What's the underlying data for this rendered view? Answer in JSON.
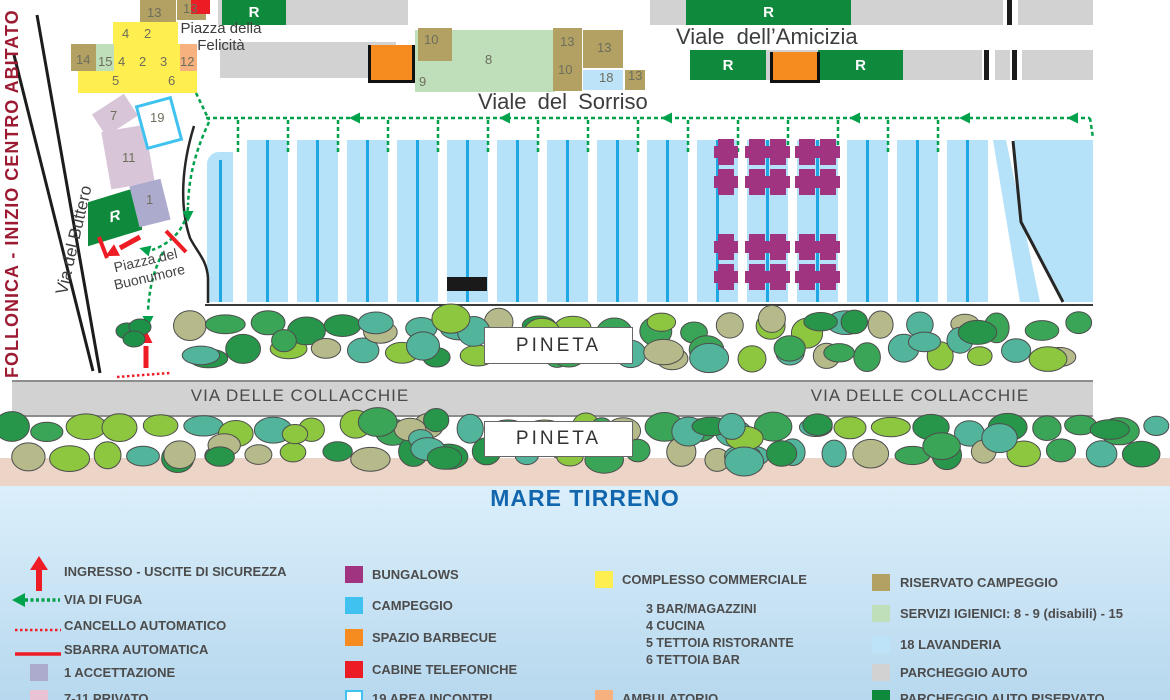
{
  "colors": {
    "khaki": "#b2a163",
    "yellow": "#ffee4f",
    "ltgreen": "#bfdfbb",
    "salmon": "#f7b17e",
    "orange": "#f68b1f",
    "red": "#ec1c24",
    "green": "#0f8a3d",
    "gray_bar": "#d2d2d2",
    "accettazione": "#adabcd",
    "privato": "#d8c6d8",
    "privato_legend": "#e9c2d4",
    "cyan": "#3fc2f0",
    "stripe": "#b5e2f8",
    "stripe_line": "#1ea7e3",
    "purple": "#a03480",
    "lavanderia": "#bce3f8",
    "sea_top": "#dbeffb",
    "sea_bottom": "#b7d8ee",
    "beach": "#ecd4c6",
    "banner": "#9c1b33",
    "road_text": "#3d3d3d",
    "legend_text": "#4c4c4c",
    "mare_text": "#1166ae",
    "route_green": "#00a14b",
    "arrow_red": "#ee1c25",
    "tree_palette": [
      "#8dc63f",
      "#3aa457",
      "#52b49b",
      "#b6ba8b",
      "#27964a"
    ],
    "tree_stroke": "#4d4d4d",
    "num": "#6e6e5c",
    "black": "#1c1c1c"
  },
  "map": {
    "banner": "FOLLONICA - INIZIO CENTRO ABITATO",
    "r_label": "R",
    "streets": {
      "amicizia": "Viale  dell’Amicizia",
      "sorriso": "Viale  del Sorriso",
      "collacchie": "VIA DELLE COLLACCHIE",
      "buttero": "Via del Buttero",
      "felicita": "Piazza della Felicità",
      "buonumore": "Piazza del Buonumore",
      "pineta": "PINETA",
      "mare": "MARE TIRRENO"
    },
    "nums": [
      {
        "t": "13",
        "x": 147,
        "y": 5
      },
      {
        "t": "13",
        "x": 183,
        "y": 1
      },
      {
        "t": "4",
        "x": 122,
        "y": 26
      },
      {
        "t": "2",
        "x": 144,
        "y": 26
      },
      {
        "t": "14",
        "x": 76,
        "y": 52
      },
      {
        "t": "15",
        "x": 98,
        "y": 54
      },
      {
        "t": "4",
        "x": 118,
        "y": 54
      },
      {
        "t": "2",
        "x": 139,
        "y": 54
      },
      {
        "t": "3",
        "x": 160,
        "y": 54
      },
      {
        "t": "12",
        "x": 180,
        "y": 54
      },
      {
        "t": "5",
        "x": 112,
        "y": 73
      },
      {
        "t": "6",
        "x": 168,
        "y": 73
      },
      {
        "t": "7",
        "x": 110,
        "y": 108
      },
      {
        "t": "19",
        "x": 150,
        "y": 110
      },
      {
        "t": "11",
        "x": 122,
        "y": 150
      },
      {
        "t": "1",
        "x": 146,
        "y": 192
      },
      {
        "t": "10",
        "x": 424,
        "y": 32
      },
      {
        "t": "8",
        "x": 485,
        "y": 52
      },
      {
        "t": "9",
        "x": 419,
        "y": 74
      },
      {
        "t": "13",
        "x": 560,
        "y": 34
      },
      {
        "t": "10",
        "x": 558,
        "y": 62
      },
      {
        "t": "13",
        "x": 597,
        "y": 40
      },
      {
        "t": "18",
        "x": 599,
        "y": 70
      },
      {
        "t": "13",
        "x": 628,
        "y": 68
      }
    ]
  },
  "legend": {
    "columns": [
      {
        "items": [
          {
            "swatch": "arrow-up",
            "label": "INGRESSO - USCITE DI SICUREZZA"
          },
          {
            "swatch": "arrow-left",
            "label": "VIA DI FUGA"
          },
          {
            "swatch": "dotted-line",
            "label": "CANCELLO AUTOMATICO"
          },
          {
            "swatch": "solid-line",
            "label": "SBARRA AUTOMATICA"
          },
          {
            "swatch": "square",
            "color": "accettazione",
            "label": "1 ACCETTAZIONE"
          },
          {
            "swatch": "square",
            "color": "privato_legend",
            "label": "7-11 PRIVATO"
          }
        ]
      },
      {
        "items": [
          {
            "swatch": "square",
            "color": "purple",
            "label": "BUNGALOWS"
          },
          {
            "swatch": "square",
            "color": "cyan",
            "label": "CAMPEGGIO"
          },
          {
            "swatch": "square",
            "color": "orange",
            "label": "SPAZIO BARBECUE"
          },
          {
            "swatch": "square",
            "color": "red",
            "label": "CABINE TELEFONICHE"
          },
          {
            "swatch": "square-outline",
            "color": "cyan",
            "label": "19 AREA INCONTRI"
          }
        ]
      },
      {
        "items": [
          {
            "swatch": "square",
            "color": "yellow",
            "label": "COMPLESSO COMMERCIALE",
            "sub": [
              "3 BAR/MAGAZZINI",
              "4 CUCINA",
              "5 TETTOIA RISTORANTE",
              "6 TETTOIA BAR"
            ]
          },
          {
            "swatch": "square",
            "color": "salmon",
            "label": "AMBULATORIO"
          }
        ]
      },
      {
        "items": [
          {
            "swatch": "square",
            "color": "khaki",
            "label": "RISERVATO CAMPEGGIO"
          },
          {
            "swatch": "square",
            "color": "ltgreen",
            "label": "SERVIZI IGIENICI: 8 - 9 (disabili) - 15"
          },
          {
            "swatch": "square",
            "color": "lavanderia",
            "label": "18 LAVANDERIA"
          },
          {
            "swatch": "square",
            "color": "gray_bar",
            "label": "PARCHEGGIO AUTO"
          },
          {
            "swatch": "square",
            "color": "green",
            "label": "PARCHEGGIO AUTO RISERVATO"
          }
        ]
      }
    ]
  }
}
